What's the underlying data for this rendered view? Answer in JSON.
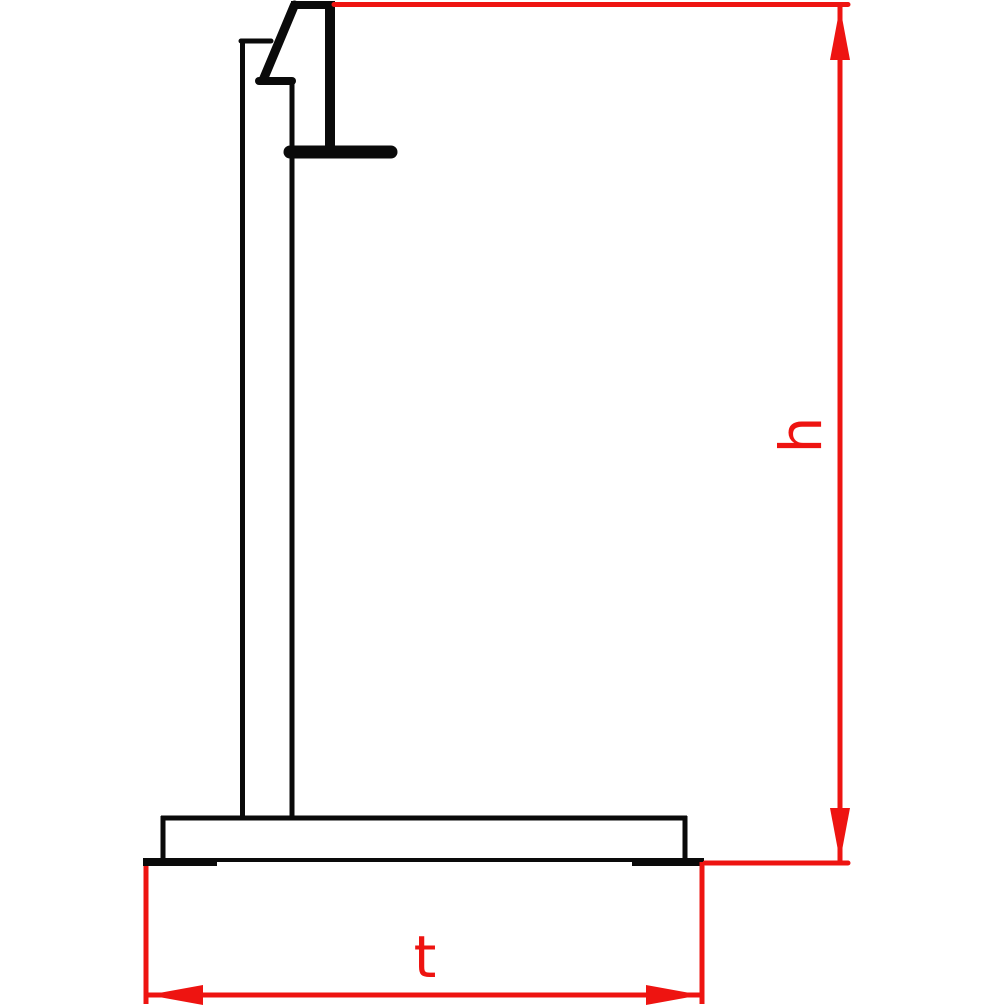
{
  "drawing": {
    "name": "stand-side-view-technical-drawing",
    "canvas": {
      "width": 1000,
      "height": 1007,
      "background": "#ffffff"
    },
    "colors": {
      "structure": "#0a0a0a",
      "dimension": "#ee1411"
    },
    "structure_lines": [
      {
        "name": "post-left-edge",
        "x1": 242.5,
        "y1": 41,
        "x2": 242.5,
        "y2": 818,
        "w": 5,
        "cap": "round"
      },
      {
        "name": "post-top-cap",
        "x1": 241,
        "y1": 41,
        "x2": 271,
        "y2": 41,
        "w": 5,
        "cap": "round"
      },
      {
        "name": "post-right-edge",
        "x1": 292,
        "y1": 83,
        "x2": 292,
        "y2": 818,
        "w": 5,
        "cap": "butt"
      },
      {
        "name": "hook-top-cap",
        "x1": 291,
        "y1": 5,
        "x2": 331,
        "y2": 5,
        "w": 8,
        "cap": "butt"
      },
      {
        "name": "hook-back-bar",
        "x1": 330,
        "y1": 1,
        "x2": 330,
        "y2": 150,
        "w": 10,
        "cap": "butt"
      },
      {
        "name": "hook-diagonal",
        "x1": 294.5,
        "y1": 5,
        "x2": 263.5,
        "y2": 79,
        "w": 9,
        "cap": "round"
      },
      {
        "name": "hook-heel",
        "x1": 259,
        "y1": 81,
        "x2": 292,
        "y2": 81,
        "w": 8,
        "cap": "round"
      },
      {
        "name": "hook-arm",
        "x1": 290,
        "y1": 152,
        "x2": 391,
        "y2": 152,
        "w": 13,
        "cap": "round"
      },
      {
        "name": "base-top-edge",
        "x1": 161,
        "y1": 818,
        "x2": 687,
        "y2": 818,
        "w": 5,
        "cap": "butt"
      },
      {
        "name": "base-left-edge",
        "x1": 163,
        "y1": 816,
        "x2": 163,
        "y2": 860,
        "w": 5,
        "cap": "butt"
      },
      {
        "name": "base-right-edge",
        "x1": 685,
        "y1": 816,
        "x2": 685,
        "y2": 860,
        "w": 5,
        "cap": "butt"
      },
      {
        "name": "base-bottom-edge",
        "x1": 217,
        "y1": 860,
        "x2": 632,
        "y2": 860,
        "w": 4,
        "cap": "butt"
      },
      {
        "name": "foot-pad-left",
        "x1": 143,
        "y1": 862,
        "x2": 217,
        "y2": 862,
        "w": 8,
        "cap": "butt"
      },
      {
        "name": "foot-pad-right",
        "x1": 632,
        "y1": 862,
        "x2": 704,
        "y2": 862,
        "w": 8,
        "cap": "butt"
      }
    ],
    "dimension_lines": [
      {
        "name": "ext-line-top",
        "x1": 334,
        "y1": 4.5,
        "x2": 848,
        "y2": 4.5,
        "w": 5,
        "cap": "round"
      },
      {
        "name": "dim-h-line",
        "x1": 840,
        "y1": 7,
        "x2": 840,
        "y2": 861,
        "w": 5,
        "cap": "butt"
      },
      {
        "name": "ext-line-bottom",
        "x1": 705,
        "y1": 863,
        "x2": 848,
        "y2": 863,
        "w": 5,
        "cap": "round"
      },
      {
        "name": "ext-line-t-left",
        "x1": 146,
        "y1": 866,
        "x2": 146,
        "y2": 1004,
        "w": 5,
        "cap": "butt"
      },
      {
        "name": "ext-line-t-right",
        "x1": 702,
        "y1": 862,
        "x2": 702,
        "y2": 1004,
        "w": 5,
        "cap": "butt"
      },
      {
        "name": "dim-t-line",
        "x1": 148,
        "y1": 995,
        "x2": 701,
        "y2": 995,
        "w": 5,
        "cap": "butt"
      }
    ],
    "arrowheads": [
      {
        "name": "dim-h-arrow-up",
        "tip": [
          840,
          7
        ],
        "dir": "up",
        "len": 53,
        "half": 10
      },
      {
        "name": "dim-h-arrow-down",
        "tip": [
          840,
          861
        ],
        "dir": "down",
        "len": 53,
        "half": 10
      },
      {
        "name": "dim-t-arrow-left",
        "tip": [
          148,
          995
        ],
        "dir": "left",
        "len": 55,
        "half": 10
      },
      {
        "name": "dim-t-arrow-right",
        "tip": [
          701,
          995
        ],
        "dir": "right",
        "len": 55,
        "half": 10
      }
    ],
    "labels": {
      "h": {
        "text": "h",
        "x": 801,
        "y": 435,
        "rotation": -90,
        "font_size": 58
      },
      "t": {
        "text": "t",
        "x": 425,
        "y": 957,
        "rotation": 0,
        "font_size": 58
      }
    }
  }
}
